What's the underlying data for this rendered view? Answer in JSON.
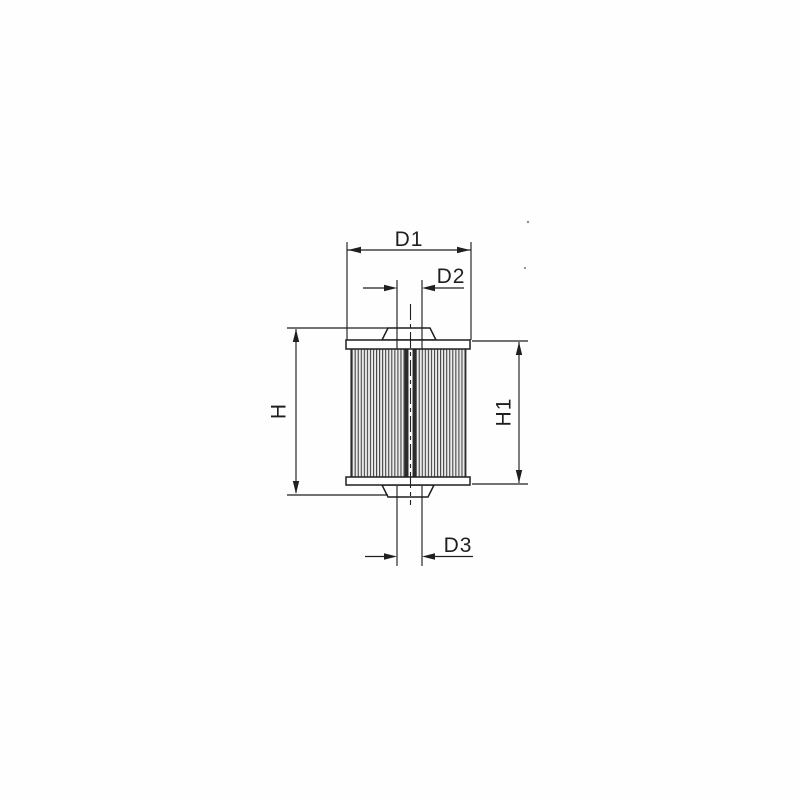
{
  "diagram": {
    "labels": {
      "d1": "D1",
      "d2": "D2",
      "d3": "D3",
      "h": "H",
      "h1": "H1"
    },
    "colors": {
      "line": "#1f1f1f",
      "background": "#fefefe",
      "pleat_fill": "#ebebeb",
      "pleat_line": "#3f3f3f",
      "tube_dark": "#2b2b2b"
    }
  }
}
